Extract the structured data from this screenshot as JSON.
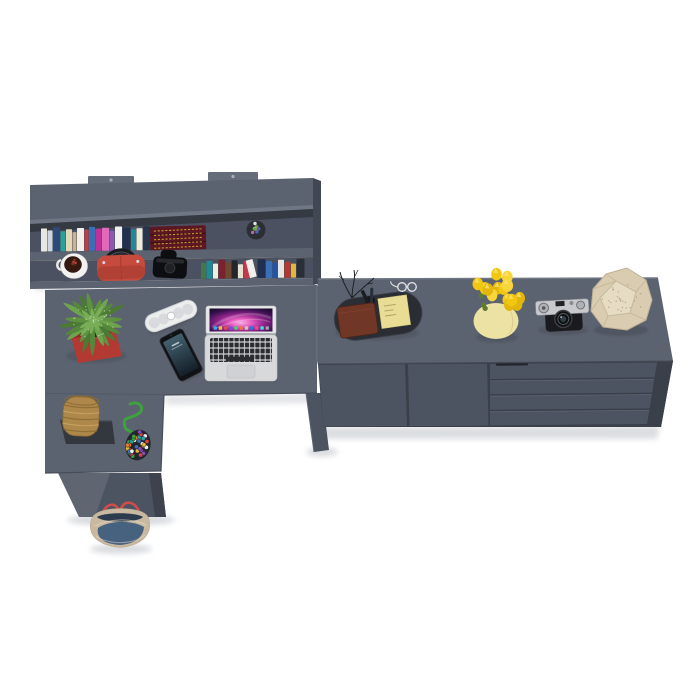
{
  "scene": {
    "description": "Top-down 3D render of a dark gray home-office furniture set: wall shelf filled with books, L-shaped desk with laptop and accessories, and a low sideboard with decor objects",
    "background": "#ffffff"
  },
  "palette": {
    "furniture_top": "#5c6370",
    "furniture_front": "#4d5461",
    "furniture_side": "#424853",
    "furniture_edge_light": "#6f7684",
    "shelf_row_bg": "#4b5160",
    "shelf_inner_shadow": "#32363f",
    "floor_shadow": "#d9dbdf",
    "pot_red": "#b23a33",
    "tulip_yellow": "#f0c513",
    "vase_cream": "#ece2a4",
    "stone_beige": "#d9ccb1",
    "wallet_brown": "#703626",
    "sticky_note": "#e9dd96",
    "handbag_red": "#c64a3d",
    "tote_denim": "#47627e",
    "tote_canvas": "#c9b9a0",
    "tote_strap_red": "#d14b4b",
    "laptop_body": "#d7d9db",
    "rope_green": "#3da23d",
    "basket_straw": "#ae884b",
    "organizer_dark": "#2a2d33",
    "camera_silver": "#c7c9cc",
    "antique_book_maroon": "#5c1722"
  },
  "objects": {
    "wall_shelf": "wall-mounted bookshelf",
    "desk": "L-shaped desk",
    "sideboard": "sideboard with two doors and four drawers",
    "laptop": "open laptop",
    "smartphone": "smartphone",
    "speaker": "pill bluetooth speaker",
    "plant": "potted plant in red planter",
    "basket": "wicker basket on stand",
    "bead_toy": "bead pouch with green rope",
    "tote_bag": "canvas and denim tote bag",
    "coffee_cup": "white cup",
    "handbag": "red handbag",
    "camera_case": "black camera case",
    "organizer": "desk organizer tray with wallet, notes and glasses",
    "tulips": "yellow tulips in cream vase",
    "camera": "vintage rangefinder camera",
    "stone": "faceted stone decor"
  },
  "decor": {
    "books_top": {
      "start_x": 41,
      "baseline_y": 251.5,
      "slope": -0.013,
      "spines": [
        {
          "w": 6,
          "h": 23,
          "c": "#e9e7e1"
        },
        {
          "w": 5,
          "h": 21,
          "c": "#cdd6e0"
        },
        {
          "w": 7,
          "h": 24,
          "c": "#2e4a7a"
        },
        {
          "w": 5,
          "h": 20,
          "c": "#2aa198"
        },
        {
          "w": 6,
          "h": 22,
          "c": "#e3d9b8"
        },
        {
          "w": 4,
          "h": 19,
          "c": "#c8b48e"
        },
        {
          "w": 7,
          "h": 23,
          "c": "#f0efeb"
        },
        {
          "w": 4,
          "h": 21,
          "c": "#c23b4a"
        },
        {
          "w": 6,
          "h": 24,
          "c": "#3b6fb5"
        },
        {
          "w": 6,
          "h": 22,
          "c": "#c2309a"
        },
        {
          "w": 7,
          "h": 23,
          "c": "#e06ab8"
        },
        {
          "w": 5,
          "h": 20,
          "c": "#8a5ab5"
        },
        {
          "w": 7,
          "h": 24,
          "c": "#f2f1ee"
        },
        {
          "w": 8,
          "h": 23,
          "c": "#22304f"
        },
        {
          "w": 5,
          "h": 21,
          "c": "#1f8a96"
        },
        {
          "w": 6,
          "h": 22,
          "c": "#efe9da"
        },
        {
          "w": 7,
          "h": 24,
          "c": "#27364d"
        }
      ]
    },
    "books_bottom": {
      "start_x": 201,
      "baseline_y": 278.8,
      "slope": -0.013,
      "spines": [
        {
          "w": 5,
          "h": 16,
          "c": "#3f7a4a"
        },
        {
          "w": 6,
          "h": 18,
          "c": "#1f8a96"
        },
        {
          "w": 5,
          "h": 15,
          "c": "#efece4"
        },
        {
          "w": 7,
          "h": 19,
          "c": "#7a2330"
        },
        {
          "w": 5,
          "h": 16,
          "c": "#6e4a2e"
        },
        {
          "w": 6,
          "h": 18,
          "c": "#23262b"
        },
        {
          "w": 5,
          "h": 14,
          "c": "#e8e2d2"
        },
        {
          "w": 6,
          "h": 17,
          "c": "#c23b4a"
        },
        {
          "w": 7,
          "h": 18,
          "c": "#f0efeb",
          "lean": -14
        },
        {
          "w": 8,
          "h": 19,
          "c": "#22304f"
        },
        {
          "w": 6,
          "h": 17,
          "c": "#3b6fb5"
        },
        {
          "w": 5,
          "h": 15,
          "c": "#2255aa"
        },
        {
          "w": 6,
          "h": 18,
          "c": "#e8e6e0"
        },
        {
          "w": 6,
          "h": 16,
          "c": "#b3392f"
        },
        {
          "w": 5,
          "h": 14,
          "c": "#e0b93a"
        },
        {
          "w": 8,
          "h": 19,
          "c": "#2a2e38"
        }
      ]
    },
    "antique_text_gold": "#c9a227",
    "succulent_colors": [
      "#4a8a3a",
      "#c04040",
      "#4466aa",
      "#e0e0e0",
      "#6fa44f",
      "#b06ab0"
    ],
    "bean_colors": [
      "#5a2c18",
      "#7a3a20",
      "#b84038",
      "#4a2412"
    ],
    "leaf_colors": [
      "#4a7a33",
      "#5e9140",
      "#6fa44f",
      "#55883b"
    ],
    "leaf_count": 22,
    "tulip_colors": [
      "#f2c712",
      "#e4b60c",
      "#f7d63c"
    ],
    "tulip_count": 16,
    "bead_colors": [
      "#d94343",
      "#3b6fb5",
      "#e0b93a",
      "#3da23d",
      "#8a4ab5",
      "#f0f0f0",
      "#e07a2e",
      "#2aa1a1"
    ],
    "bead_count": 42,
    "dock_colors": [
      "#4aa3e8",
      "#e8c54a",
      "#d94f4f",
      "#7a52c9",
      "#4ac98a",
      "#e87a3a",
      "#c4c8cc",
      "#3a6fd9",
      "#e84a9a",
      "#4ad9d9",
      "#9aa0a8"
    ]
  }
}
